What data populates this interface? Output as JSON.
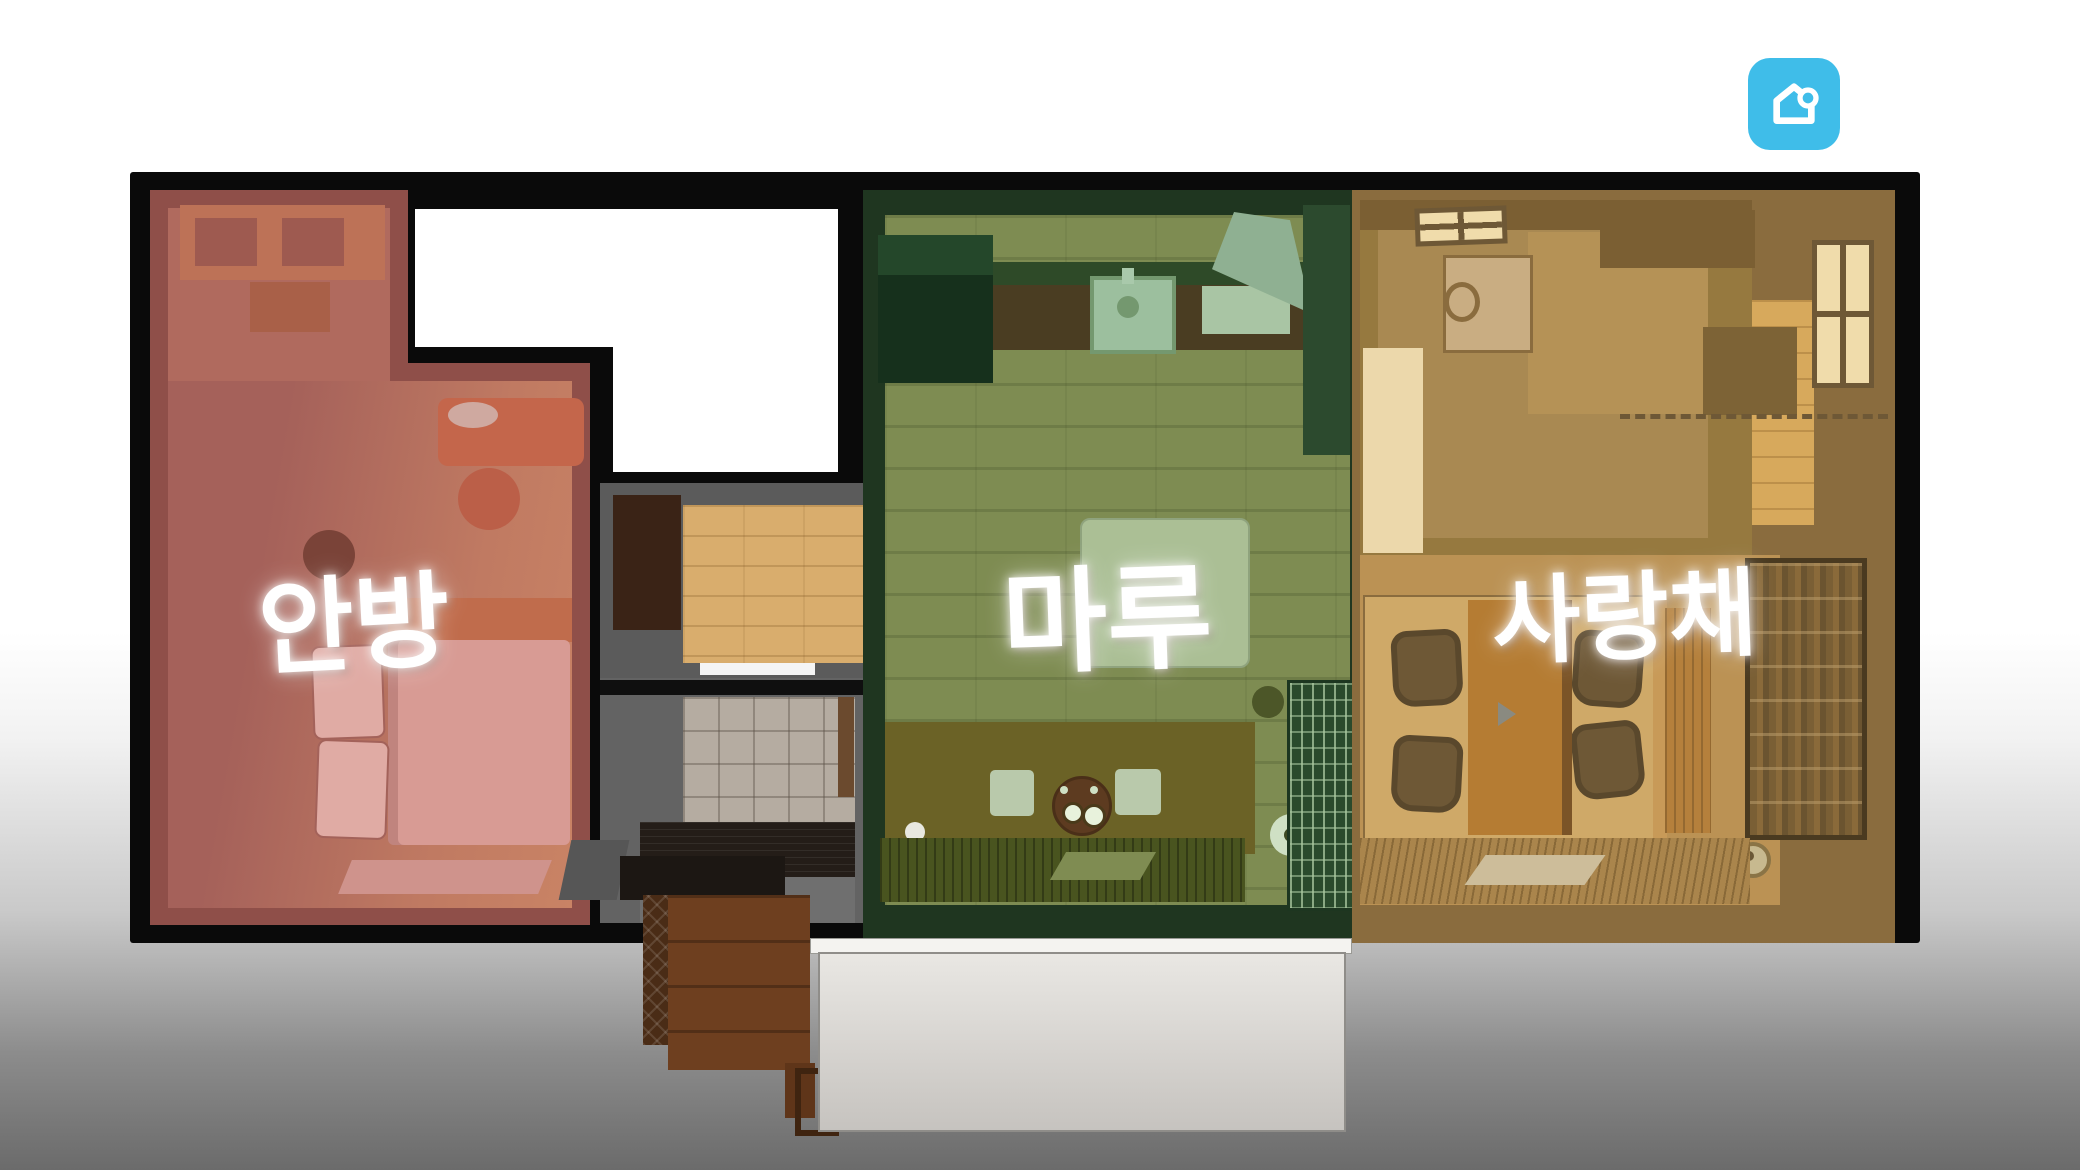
{
  "watermark": {
    "icon": "home-app-icon",
    "color": "#3FBDE9"
  },
  "floorplan": {
    "rooms": [
      {
        "id": "anbang",
        "label": "안방",
        "tint": "#A96258"
      },
      {
        "id": "maru",
        "label": "마루",
        "tint": "#7E8C52"
      },
      {
        "id": "sarangchae",
        "label": "사랑채",
        "tint": "#BB9254"
      }
    ],
    "palette": {
      "wall": "#0A0A0A",
      "background_top": "#FFFFFF",
      "background_bottom": "#6B6B6B",
      "notch": "#FFFFFF",
      "hall_wood": "#D9AD6D",
      "porch": "#DDDAD5"
    }
  }
}
